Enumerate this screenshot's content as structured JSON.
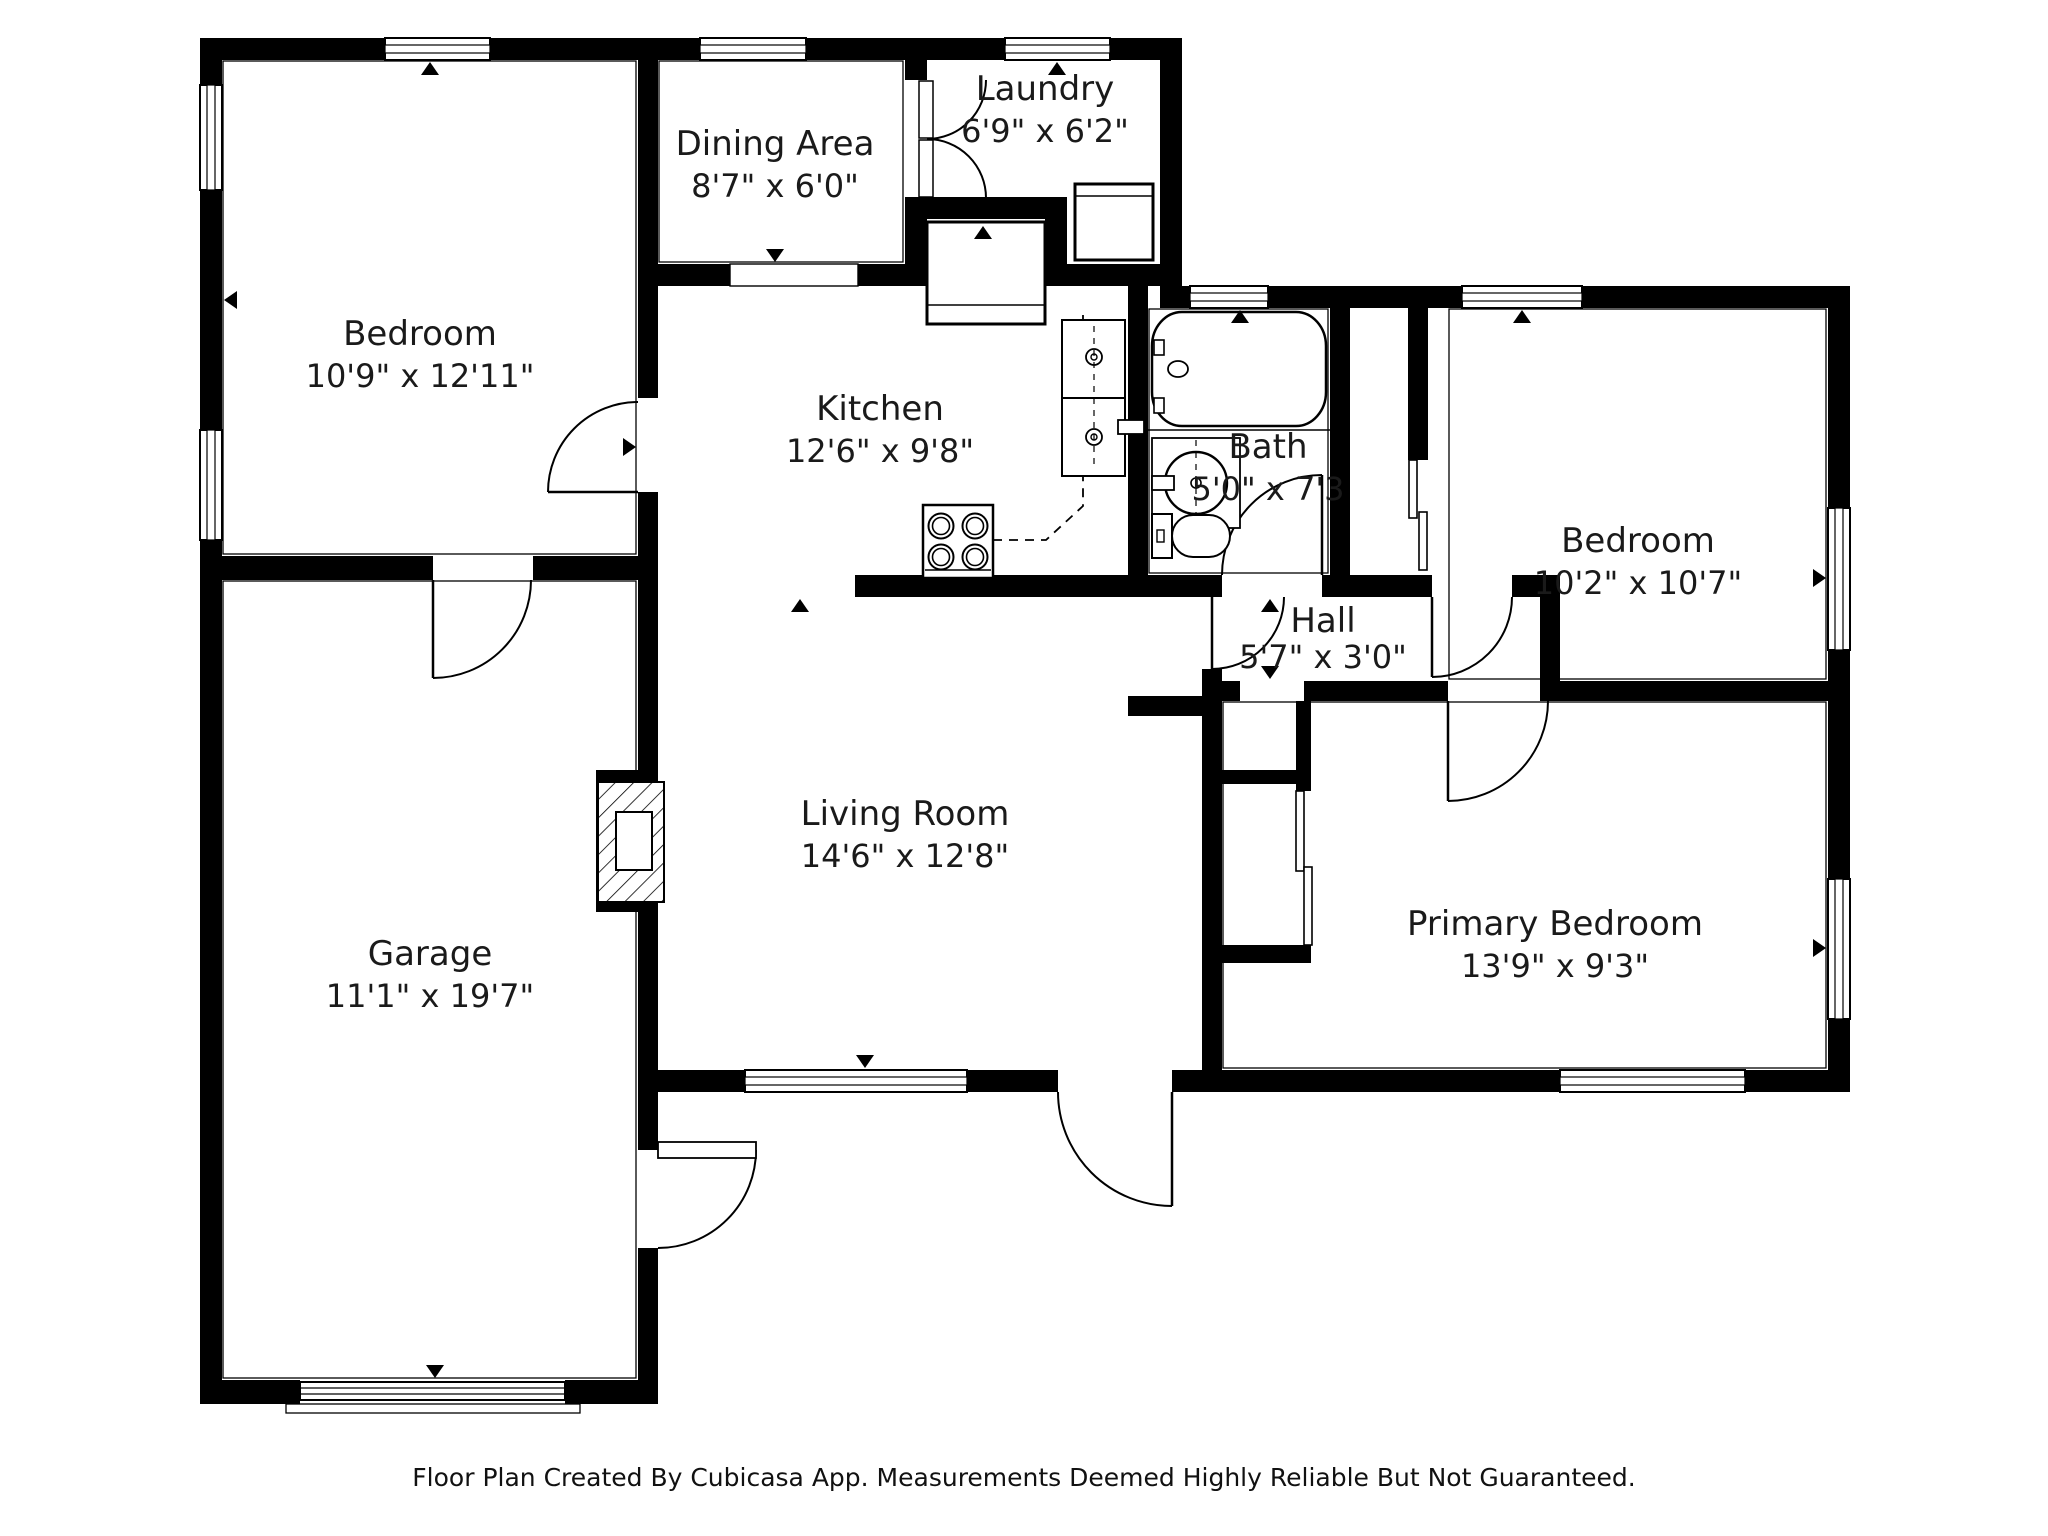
{
  "rooms": [
    {
      "id": "bedroom-top-left",
      "name": "Bedroom",
      "dims": "10'9\" x 12'11\""
    },
    {
      "id": "dining-area",
      "name": "Dining Area",
      "dims": "8'7\" x 6'0\""
    },
    {
      "id": "laundry",
      "name": "Laundry",
      "dims": "6'9\" x 6'2\""
    },
    {
      "id": "kitchen",
      "name": "Kitchen",
      "dims": "12'6\" x 9'8\""
    },
    {
      "id": "bath",
      "name": "Bath",
      "dims": "5'0\" x 7'3"
    },
    {
      "id": "bedroom-right",
      "name": "Bedroom",
      "dims": "10'2\" x 10'7\""
    },
    {
      "id": "hall",
      "name": "Hall",
      "dims": "5'7\" x 3'0\""
    },
    {
      "id": "living-room",
      "name": "Living Room",
      "dims": "14'6\" x 12'8\""
    },
    {
      "id": "garage",
      "name": "Garage",
      "dims": "11'1\" x 19'7\""
    },
    {
      "id": "primary-bedroom",
      "name": "Primary Bedroom",
      "dims": "13'9\" x 9'3\""
    }
  ],
  "footer": {
    "text": "Floor Plan Created By Cubicasa App. Measurements Deemed Highly Reliable But Not Guaranteed."
  },
  "colors": {
    "wall": "#000000",
    "floor": "#ffffff",
    "label": "#1a1a1a"
  }
}
